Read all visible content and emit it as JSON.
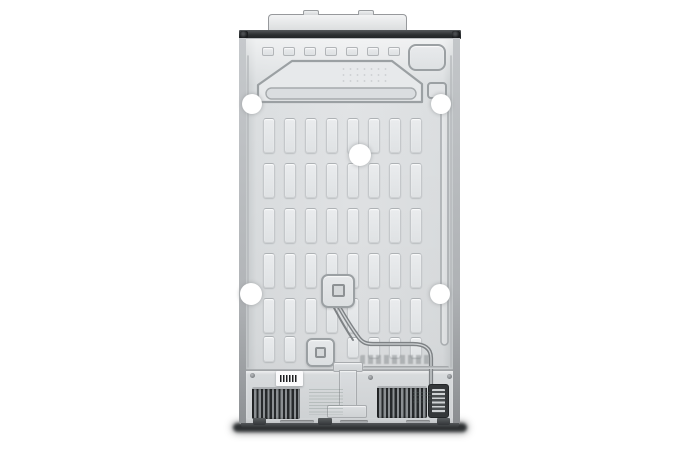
{
  "meta": {
    "subject": "refrigerator-rear-view-product-photo"
  },
  "colors": {
    "bg": "#ffffff",
    "panel": "#e2e4e6",
    "panel_light": "#e8eaec",
    "panel_edge": "#c2c5c8",
    "emboss_line": "#9ba0a3",
    "dark_trim": "#2b2e30",
    "slat_dark": "#26292b",
    "slat_light": "#8b8f92",
    "shadow": "#2e3133",
    "sticker": "#ffffff",
    "tube": "#7e8285",
    "barcode_bg": "#fbfbfc",
    "barcode_bar": "#1c1e20"
  },
  "back_panel": {
    "slot_columns_x": [
      263,
      284,
      305,
      326,
      347,
      368,
      389,
      410
    ],
    "slot_width": 12,
    "slot_rows": [
      {
        "y": 118,
        "h": 35,
        "cols": [
          0,
          1,
          2,
          3,
          4,
          5,
          6,
          7
        ]
      },
      {
        "y": 163,
        "h": 35,
        "cols": [
          0,
          1,
          2,
          3,
          4,
          5,
          6,
          7
        ]
      },
      {
        "y": 208,
        "h": 35,
        "cols": [
          0,
          1,
          2,
          3,
          4,
          5,
          6,
          7
        ]
      },
      {
        "y": 253,
        "h": 35,
        "cols": [
          0,
          1,
          2,
          3,
          4,
          5,
          6,
          7
        ]
      },
      {
        "y": 298,
        "h": 35,
        "cols": [
          0,
          1,
          2,
          3,
          4,
          5,
          6,
          7
        ]
      },
      {
        "y": 336,
        "h": 26,
        "cols": [
          0,
          1
        ]
      },
      {
        "y": 337,
        "h": 21,
        "cols": [
          4,
          5,
          6,
          7
        ]
      }
    ],
    "top_slots": {
      "y": 47,
      "h": 9,
      "w": 12,
      "xs": [
        262,
        283,
        304,
        325,
        346,
        367,
        388
      ]
    },
    "stickers": [
      {
        "x": 252,
        "y": 104,
        "r": 10
      },
      {
        "x": 441,
        "y": 104,
        "r": 10
      },
      {
        "x": 360,
        "y": 155,
        "r": 11
      },
      {
        "x": 251,
        "y": 294,
        "r": 11
      },
      {
        "x": 440,
        "y": 294,
        "r": 10
      }
    ],
    "seam_screws": [
      {
        "x": 250,
        "y": 373
      },
      {
        "x": 368,
        "y": 375
      },
      {
        "x": 447,
        "y": 374
      }
    ],
    "rail_slots": [
      {
        "x": 280,
        "w": 34
      },
      {
        "x": 340,
        "w": 28
      },
      {
        "x": 406,
        "w": 24
      }
    ],
    "feet": [
      {
        "x": 253,
        "w": 13
      },
      {
        "x": 318,
        "w": 14
      },
      {
        "x": 437,
        "w": 13
      }
    ]
  }
}
